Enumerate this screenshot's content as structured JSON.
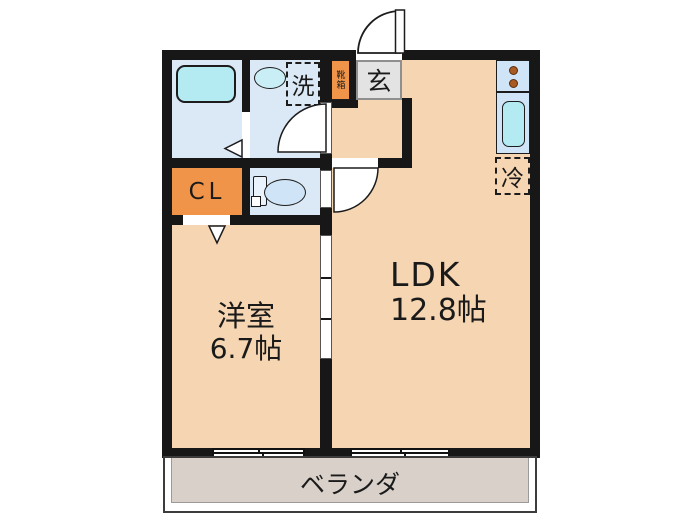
{
  "plan": {
    "rooms": {
      "western": {
        "name": "洋室",
        "size": "6.7帖"
      },
      "ldk": {
        "name": "LDK",
        "size": "12.8帖"
      },
      "veranda": {
        "name": "ベランダ"
      },
      "entrance": {
        "name": "玄"
      },
      "closet": {
        "name": "CL"
      },
      "shoe_box": {
        "name": "靴箱"
      },
      "washer_space": {
        "name": "洗"
      },
      "fridge_space": {
        "name": "冷"
      }
    },
    "colors": {
      "room_floor": "#f6d5b2",
      "wet_area_floor": "#dbe9f6",
      "fixture_accent": "#b4ebf2",
      "storage_orange": "#ef9449",
      "entrance_floor": "#e3e3e3",
      "veranda_floor": "#d8d0c9",
      "wall": "#171717"
    }
  }
}
